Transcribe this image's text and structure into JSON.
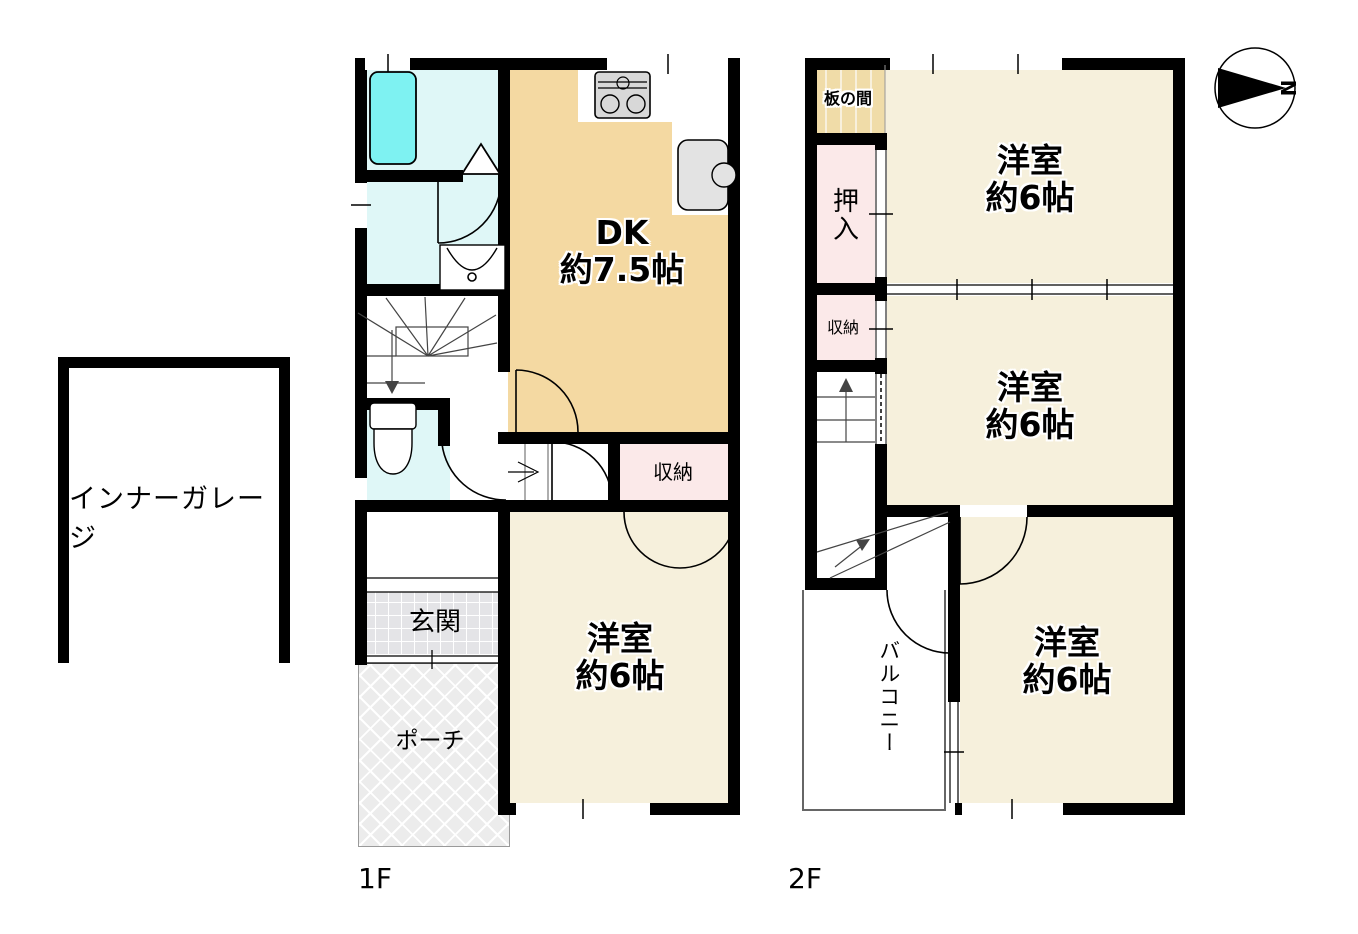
{
  "compass": {
    "letter": "N"
  },
  "garage": {
    "label": "インナーガレージ"
  },
  "floors": {
    "f1": {
      "label": "1F",
      "rooms": {
        "dk": {
          "name": "DK",
          "size": "約7.5帖"
        },
        "western_room": {
          "name": "洋室",
          "size": "約6帖"
        },
        "storage": {
          "name": "収納"
        },
        "entrance": {
          "name": "玄関"
        },
        "porch": {
          "name": "ポーチ"
        }
      }
    },
    "f2": {
      "label": "2F",
      "rooms": {
        "board_room": {
          "name": "板の間"
        },
        "oshiire": {
          "name": "押入"
        },
        "storage": {
          "name": "収納"
        },
        "western_room_north": {
          "name": "洋室",
          "size": "約6帖"
        },
        "western_room_center": {
          "name": "洋室",
          "size": "約6帖"
        },
        "western_room_south": {
          "name": "洋室",
          "size": "約6帖"
        },
        "balcony": {
          "name": "バルコニー"
        }
      }
    }
  },
  "colors": {
    "wall": "#000000",
    "dk_floor": "#F4D9A2",
    "room_floor": "#F6F0DC",
    "wet_floor": "#DFF7F7",
    "bathtub": "#7EF2F2",
    "closet_pink": "#FBE9E9",
    "entrance_tile": "#E4E4E7",
    "porch_gray": "#ECECEC"
  }
}
